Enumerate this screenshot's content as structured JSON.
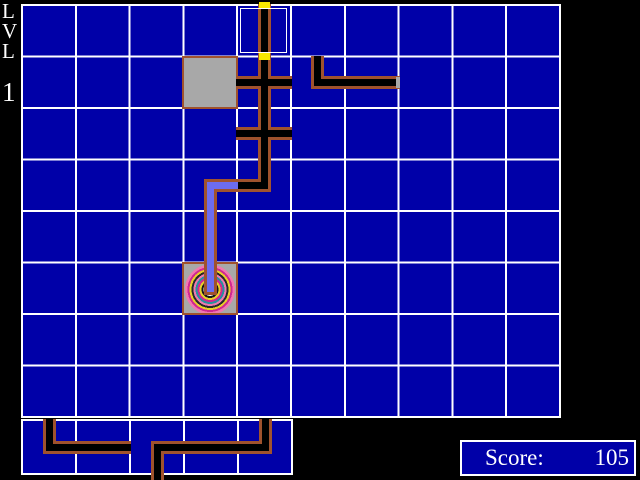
{
  "hud": {
    "level": {
      "char1": "L",
      "char2": "V",
      "char3": "L",
      "number": "1"
    },
    "score": {
      "label": "Score:",
      "value": "105"
    }
  },
  "colors": {
    "background": "#000000",
    "cell_blue": "#0000A8",
    "grid_line": "#FFFFFF",
    "pipe_fill": "#000000",
    "pipe_border": "#A0522D",
    "water_fill": "#6C6CF0",
    "cap_yellow": "#F8E800",
    "block_gray": "#A8A8A8",
    "text_white": "#FFFFFF",
    "ring_colors": [
      "#002000",
      "#00A800",
      "#F0F0F0",
      "#181818",
      "#E8D028",
      "#D02890",
      "#2890A0",
      "#F078B0",
      "#282828",
      "#E8D028",
      "#D02890",
      "#F078B0"
    ]
  },
  "board": {
    "cols": 10,
    "rows": 8,
    "cursor": {
      "col": 4,
      "row": 0
    },
    "pieces": [
      {
        "name": "start-pipe",
        "col": 4,
        "row": 0,
        "arms": [
          "up",
          "down"
        ],
        "fill": "black",
        "caps": [
          "up",
          "down"
        ]
      },
      {
        "name": "cross-pipe",
        "col": 4,
        "row": 1,
        "arms": [
          "up",
          "down",
          "left",
          "right"
        ],
        "fill": "black"
      },
      {
        "name": "cross-pipe",
        "col": 4,
        "row": 2,
        "arms": [
          "up",
          "down",
          "left",
          "right"
        ],
        "fill": "black"
      },
      {
        "name": "elbow-pipe",
        "col": 4,
        "row": 3,
        "arms": [
          "up",
          "left"
        ],
        "fill": "black"
      },
      {
        "name": "elbow-pipe-filled",
        "col": 3,
        "row": 3,
        "arms": [
          "right",
          "down"
        ],
        "fill": "water"
      },
      {
        "name": "straight-pipe-filled",
        "col": 3,
        "row": 4,
        "arms": [
          "up",
          "down"
        ],
        "fill": "water"
      },
      {
        "name": "target-spiral",
        "col": 3,
        "row": 5,
        "type": "target",
        "arms": [
          "up"
        ],
        "fill": "water"
      },
      {
        "name": "blocked-cell",
        "col": 3,
        "row": 1,
        "type": "block"
      },
      {
        "name": "elbow-pipe",
        "col": 5,
        "row": 1,
        "arms": [
          "up",
          "right"
        ],
        "fill": "black"
      },
      {
        "name": "straight-pipe",
        "col": 6,
        "row": 1,
        "arms": [
          "left",
          "right"
        ],
        "fill": "black",
        "end_cap": "right"
      }
    ]
  },
  "queue": {
    "cols": 5,
    "rows": 1,
    "pieces": [
      {
        "name": "queue-elbow-up-right",
        "col": 0,
        "row": 0,
        "arms": [
          "up",
          "right"
        ],
        "fill": "black"
      },
      {
        "name": "queue-straight",
        "col": 1,
        "row": 0,
        "arms": [
          "left",
          "right"
        ],
        "fill": "black"
      },
      {
        "name": "queue-elbow-right-down",
        "col": 2,
        "row": 0,
        "arms": [
          "right",
          "down"
        ],
        "fill": "black",
        "extend": "down"
      },
      {
        "name": "queue-straight",
        "col": 3,
        "row": 0,
        "arms": [
          "left",
          "right"
        ],
        "fill": "black"
      },
      {
        "name": "queue-elbow-left-up",
        "col": 4,
        "row": 0,
        "arms": [
          "left",
          "up"
        ],
        "fill": "black"
      }
    ]
  }
}
